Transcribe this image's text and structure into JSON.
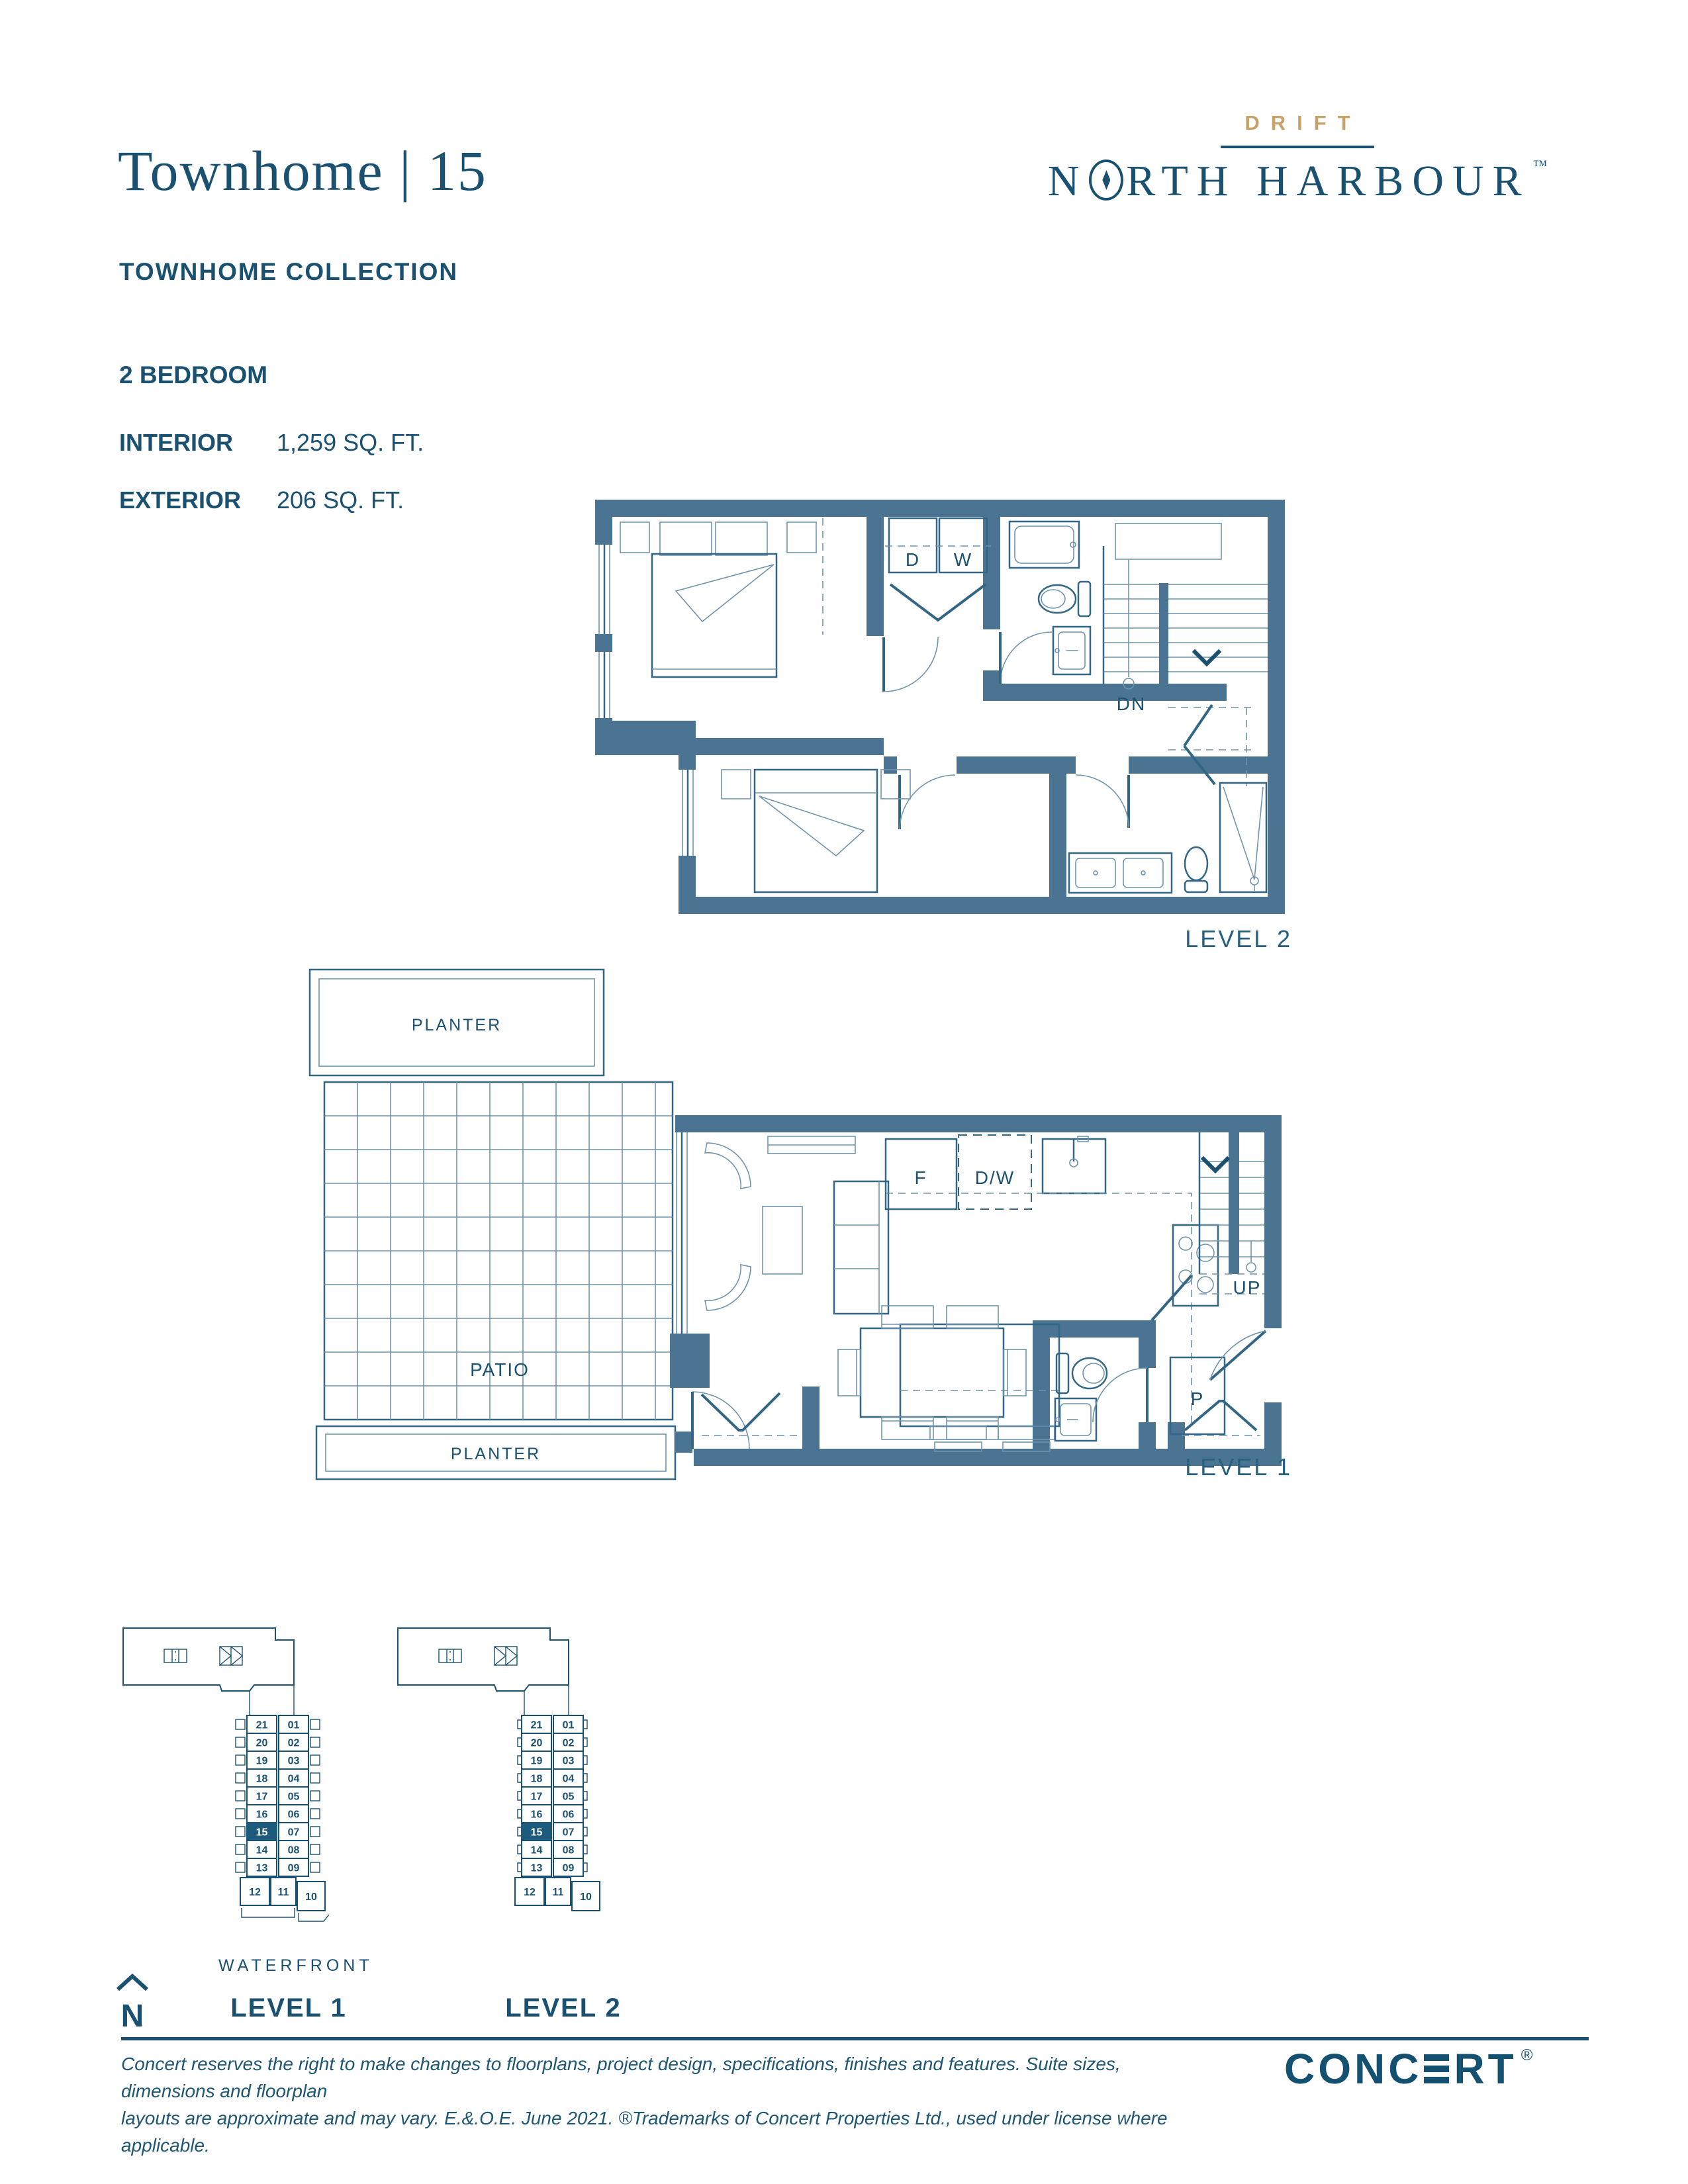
{
  "document": {
    "plan_name": "Townhome | 15",
    "collection": "TOWNHOME COLLECTION",
    "bedrooms": "2 BEDROOM",
    "interior_label": "INTERIOR",
    "interior_value": "1,259 SQ. FT.",
    "exterior_label": "EXTERIOR",
    "exterior_value": "206 SQ. FT."
  },
  "brand": {
    "drift": "DRIFT",
    "north_prefix": "N",
    "north_suffix": "RTH HARBOUR",
    "trademark": "TM"
  },
  "floorplans": {
    "level2": {
      "label": "LEVEL 2",
      "laundry_dryer": "D",
      "laundry_washer": "W",
      "stairs_down": "DN"
    },
    "level1": {
      "label": "LEVEL 1",
      "planter_top": "PLANTER",
      "planter_bottom": "PLANTER",
      "patio": "PATIO",
      "fridge": "F",
      "dishwasher": "D/W",
      "pantry": "P",
      "stairs_up": "UP"
    }
  },
  "keyplans": {
    "left_column": [
      "21",
      "20",
      "19",
      "18",
      "17",
      "16",
      "15",
      "14",
      "13"
    ],
    "right_column": [
      "01",
      "02",
      "03",
      "04",
      "05",
      "06",
      "07",
      "08",
      "09"
    ],
    "bottom_row": [
      "12",
      "11",
      "10"
    ],
    "highlighted_unit": "15",
    "waterfront_label": "WATERFRONT",
    "north_label": "N",
    "level1_label": "LEVEL 1",
    "level2_label": "LEVEL 2"
  },
  "footer": {
    "disclaimer_line1": "Concert reserves the right to make changes to floorplans, project design, specifications, finishes and features. Suite sizes, dimensions and floorplan",
    "disclaimer_line2": "layouts are approximate and may vary.  E.&.O.E.  June 2021.  ®Trademarks of Concert Properties Ltd., used under license where applicable.",
    "concert_word_left": "CONC",
    "concert_word_right": "RT",
    "registered": "®"
  },
  "colors": {
    "teal_dark": "#1B5170",
    "wall_blue": "#4A7492",
    "gold": "#C7A268",
    "highlight": "#1D5B7D"
  }
}
